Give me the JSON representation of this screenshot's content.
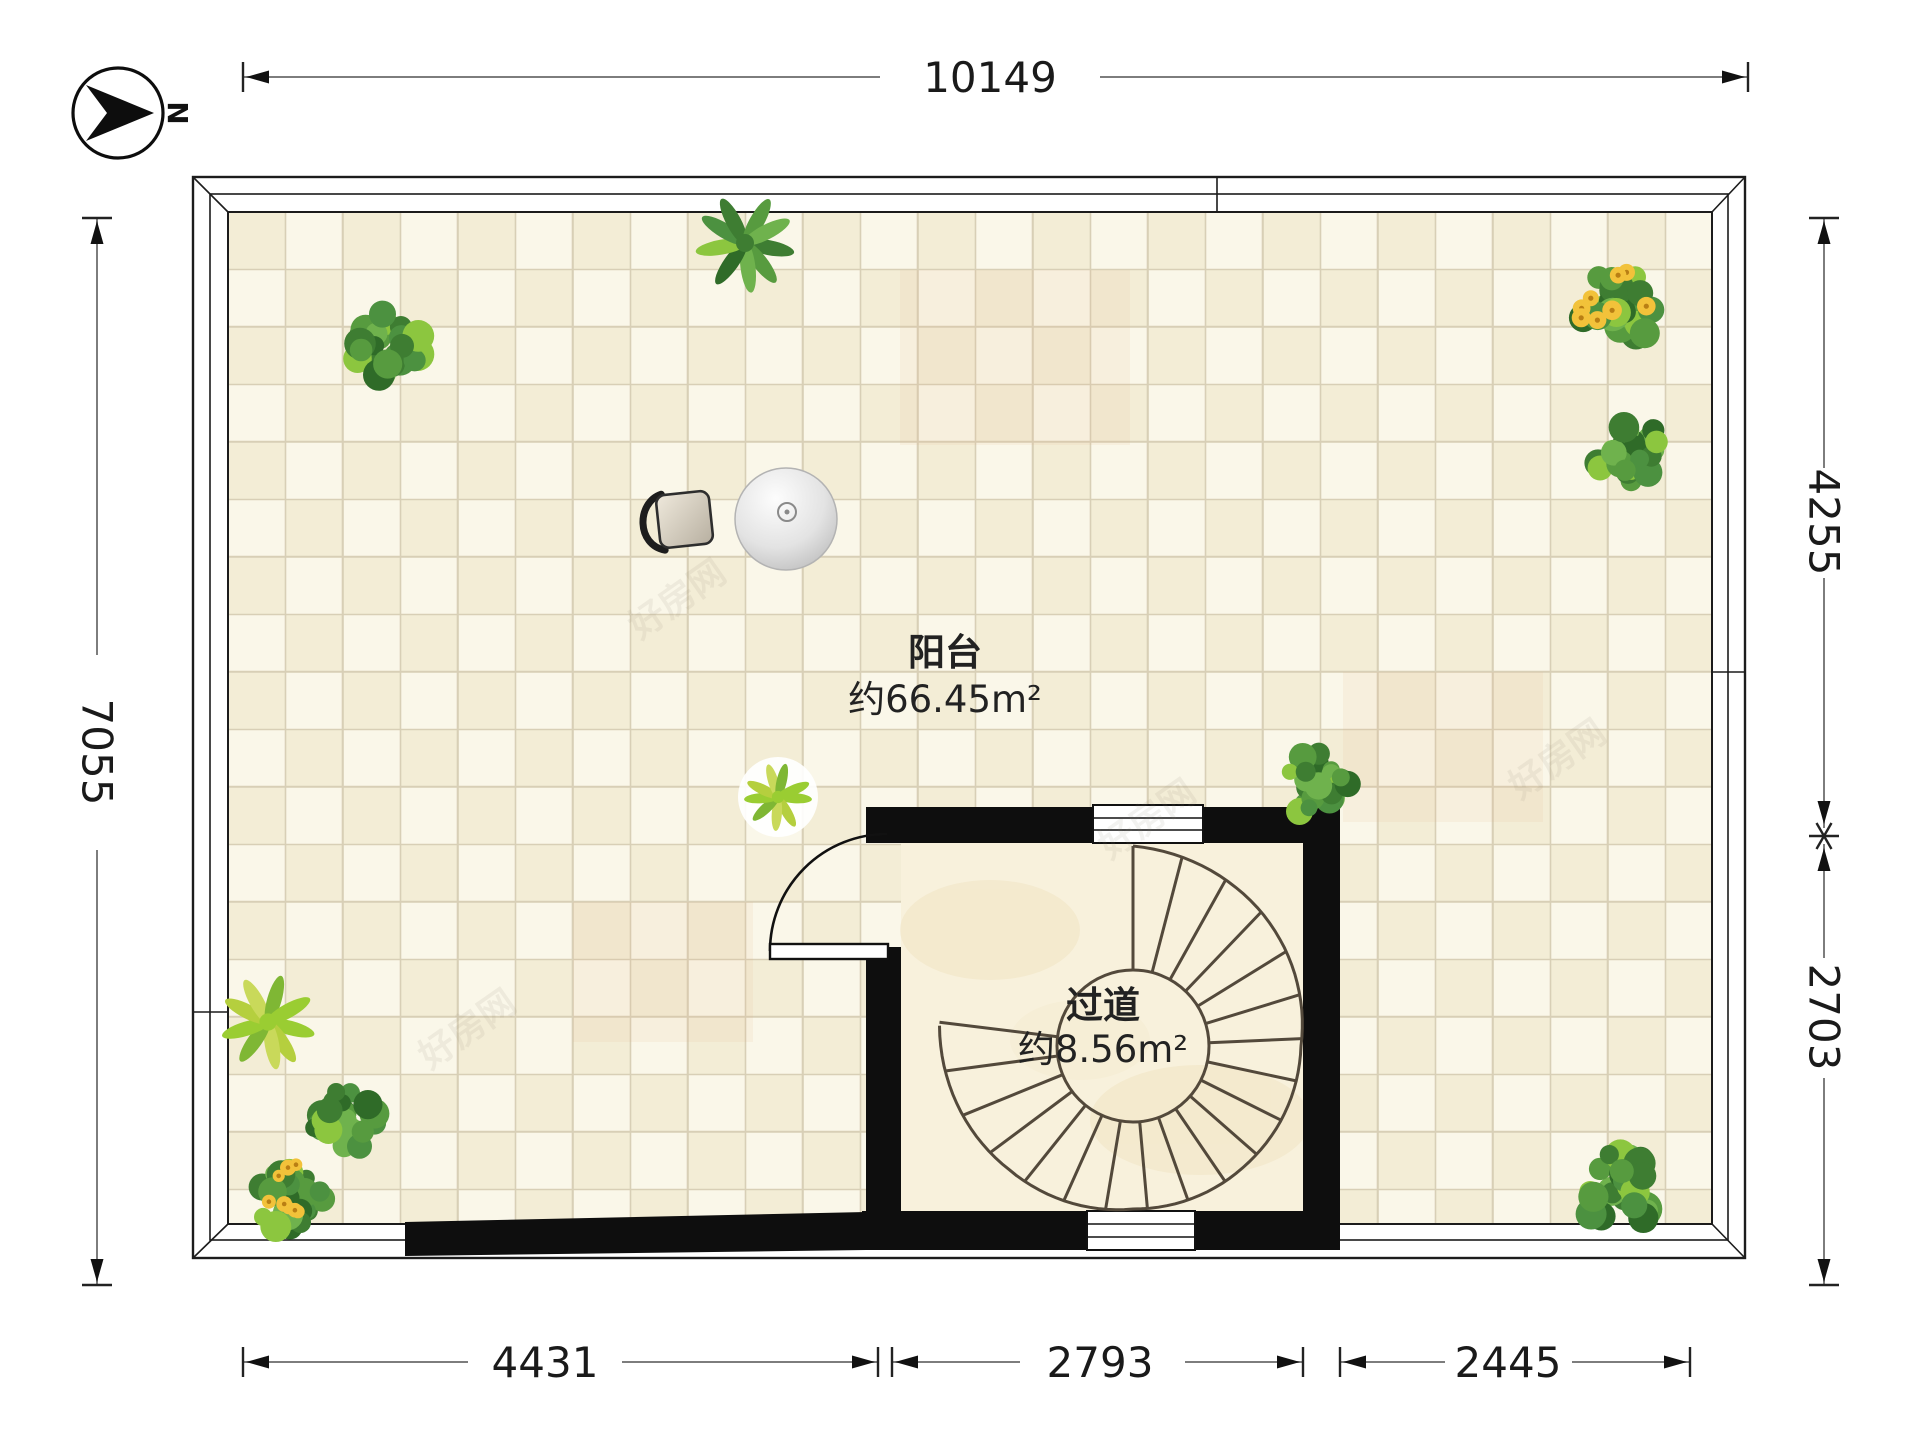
{
  "compass": {
    "north_label": "N"
  },
  "rooms": {
    "balcony": {
      "name": "阳台",
      "area": "约66.45m²"
    },
    "corridor": {
      "name": "过道",
      "area": "约8.56m²"
    }
  },
  "dimensions": {
    "top": "10149",
    "left": "7055",
    "right_upper": "4255",
    "right_lower": "2703",
    "bottom_left": "4431",
    "bottom_middle": "2793",
    "bottom_right": "2445"
  },
  "watermark": {
    "text": "好房网"
  },
  "colors": {
    "tile_light": "#faf7e9",
    "tile_dark": "#f3edd6",
    "grout": "#d8cfb6",
    "wall": "#0e0e0e",
    "stair_floor": "#f8f1dc",
    "dim_line": "#7d7d7d",
    "text_dark": "#1a1a1a",
    "plan_border": "#1c1c1c",
    "plant_green": "#4f9a3d",
    "flower_yellow": "#f2c23a"
  }
}
